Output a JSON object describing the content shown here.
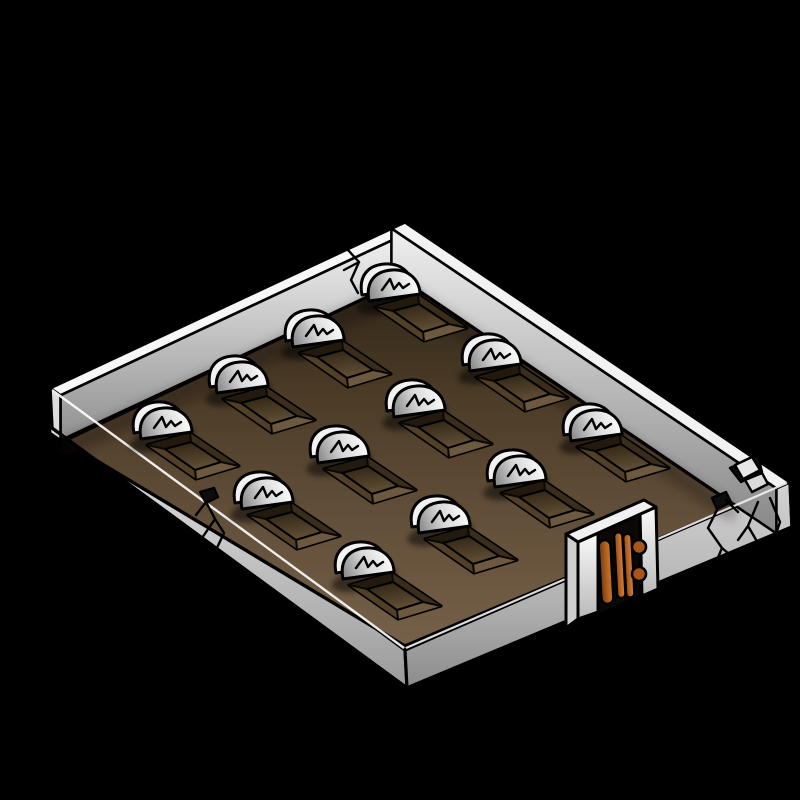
{
  "scene": {
    "subject": "Isometric walled graveyard illustration with twelve graves and a wooden gate",
    "style": "RPG map symbol clip-art, black background",
    "background_color": "#000000",
    "grave_count": 12,
    "grid": {
      "rows": 4,
      "cols": 3,
      "origin": {
        "x": 395,
        "y": 287
      },
      "col_step": {
        "x": 101,
        "y": 70
      },
      "row_step": {
        "x": -76,
        "y": 46
      }
    },
    "graves": [
      {
        "row": 0,
        "col": 0,
        "x": 395,
        "y": 287
      },
      {
        "row": 0,
        "col": 1,
        "x": 496,
        "y": 357
      },
      {
        "row": 0,
        "col": 2,
        "x": 597,
        "y": 427
      },
      {
        "row": 1,
        "col": 0,
        "x": 319,
        "y": 333
      },
      {
        "row": 1,
        "col": 1,
        "x": 420,
        "y": 403
      },
      {
        "row": 1,
        "col": 2,
        "x": 521,
        "y": 473
      },
      {
        "row": 2,
        "col": 0,
        "x": 243,
        "y": 379
      },
      {
        "row": 2,
        "col": 1,
        "x": 344,
        "y": 449
      },
      {
        "row": 2,
        "col": 2,
        "x": 445,
        "y": 519
      },
      {
        "row": 3,
        "col": 0,
        "x": 167,
        "y": 425
      },
      {
        "row": 3,
        "col": 1,
        "x": 268,
        "y": 495
      },
      {
        "row": 3,
        "col": 2,
        "x": 369,
        "y": 565
      }
    ],
    "headstone": {
      "shape": "rounded arch",
      "inscription_mark": "zigzag scratch"
    },
    "walls": {
      "raised_sides": [
        "northwest",
        "northeast"
      ],
      "cracks": [
        {
          "name": "northwest-wall-crack",
          "x": 352,
          "y": 262
        },
        {
          "name": "southwest-rim-crack",
          "x": 212,
          "y": 524
        },
        {
          "name": "southeast-wall-crack",
          "x": 722,
          "y": 538
        },
        {
          "name": "east-corner-break",
          "x": 755,
          "y": 492
        }
      ]
    },
    "gate": {
      "position": "southeast-edge",
      "door_leaves": 2,
      "hinge_knobs": 2,
      "material": "wood planks"
    },
    "colors": {
      "background": "#000000",
      "outline": "#000000",
      "stone_white": "#ffffff",
      "stone_gray": "#8f8f8f",
      "wall_light": "#f2f2f2",
      "wall_shade": "#9a9a9a",
      "slab_light": "#e3e3e3",
      "slab_dark": "#8c8c8c",
      "ground_dark": "#33281a",
      "ground_mid": "#5f4c36",
      "ground_light": "#77614a",
      "plot_bevel_dark": "#221a0e",
      "plot_floor_dark": "#302515",
      "plot_floor_light": "#5e4b33",
      "wood_light": "#d88a3e",
      "wood_mid": "#b4631f",
      "wood_dark": "#6e3a10"
    }
  }
}
